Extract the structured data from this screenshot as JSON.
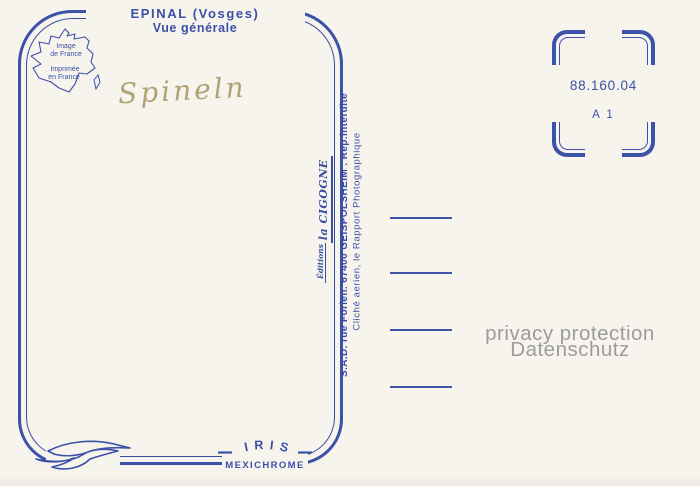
{
  "postcard": {
    "title_line1": "EPINAL (Vosges)",
    "title_line2": "Vue générale",
    "handwriting": "Spineln",
    "print_mark_line1": "Image",
    "print_mark_line2": "de France",
    "print_mark_line3": "Imprimée",
    "print_mark_line4": "en France",
    "publisher_editions": "Éditions",
    "publisher_name": "la CIGOGNE",
    "publisher_address": "S.A.D. rue Forlen. 67400 GEISPOLSHEIM . Rep.interdite",
    "publisher_credit": "Cliché aerien, le Rapport Photographique",
    "brand_name": "IRIS",
    "brand_process": "MEXICHROME"
  },
  "stamp_area": {
    "reference": "88.160.04",
    "series": "A 1"
  },
  "watermark": {
    "line1": "privacy protection",
    "line2": "Datenschutz"
  },
  "colors": {
    "ink_blue": "#3c51a8",
    "handwriting_tan": "#b1a276",
    "watermark_gray": "#9c9c9c",
    "paper": "#f7f4ed"
  }
}
